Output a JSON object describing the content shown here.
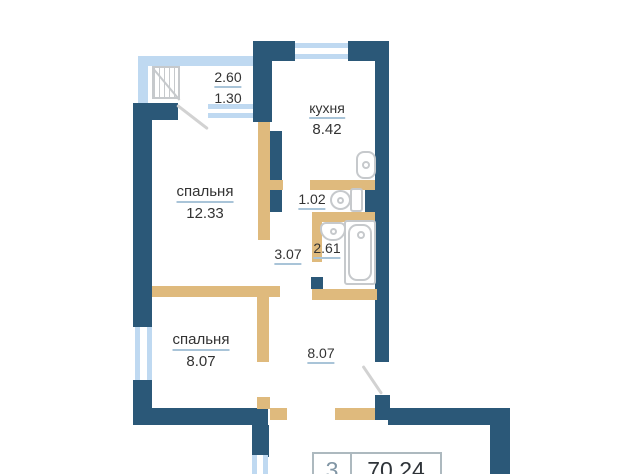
{
  "colors": {
    "wall_ext": "#2B5878",
    "wall_int": "#DFBA7D",
    "win_frame": "#BFD9F1",
    "underline": "#A9C4D8",
    "text": "#333333",
    "fixture": "#C6C9CC",
    "diag": "#D2D2D2",
    "box_border": "#ADB9BF",
    "box_rooms": "#8095A4",
    "box_area": "#2E3338"
  },
  "balcony": {
    "area_total": "2.60",
    "area_reduced": "1.30"
  },
  "rooms": {
    "kitchen": {
      "name": "кухня",
      "area": "8.42"
    },
    "bedroom1": {
      "name": "спальня",
      "area": "12.33"
    },
    "bedroom2": {
      "name": "спальня",
      "area": "8.07"
    },
    "wc": {
      "area": "1.02"
    },
    "corridor": {
      "area": "3.07"
    },
    "bathroom": {
      "area": "2.61"
    },
    "hall": {
      "area": "8.07"
    }
  },
  "summary": {
    "rooms_count": "3",
    "total_area": "70.24"
  }
}
